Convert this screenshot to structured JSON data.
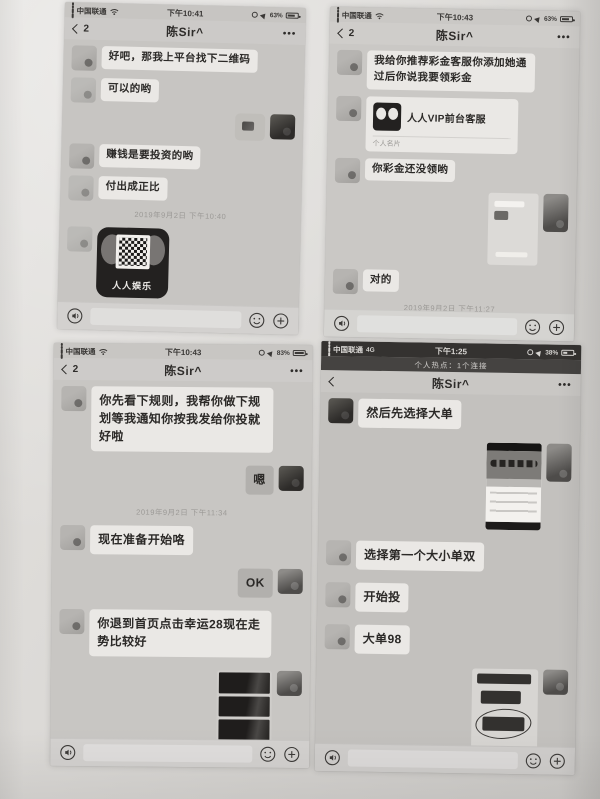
{
  "icons": {
    "more": "•••"
  },
  "phones": [
    {
      "status": {
        "carrier": "中国联通",
        "time": "下午10:41",
        "battery": "63%"
      },
      "nav": {
        "unread": "2",
        "title": "陈Sir^"
      },
      "messages": {
        "m1": "好吧，那我上平台找下二维码",
        "m2": "可以的哟",
        "m3": "赚钱是要投资的哟",
        "m4": "付出成正比",
        "timestamp": "2019年9月2日 下午10:40",
        "qr_label": "人人娱乐",
        "m5": "你扫码进入按里面点击右上角三个点，在浏览器打开下载"
      }
    },
    {
      "status": {
        "carrier": "中国联通",
        "time": "下午10:43",
        "battery": "63%"
      },
      "nav": {
        "unread": "2",
        "title": "陈Sir^"
      },
      "messages": {
        "m1": "我给你推荐彩金客服你添加她通过后你说我要领彩金",
        "card_title": "人人VIP前台客服",
        "card_subtitle": "个人名片",
        "m2": "你彩金还没领哟",
        "m3": "对的",
        "timestamp": "2019年9月2日 下午11:27"
      }
    },
    {
      "status": {
        "carrier": "中国联通",
        "time": "下午10:43",
        "battery": "83%"
      },
      "nav": {
        "unread": "2",
        "title": "陈Sir^"
      },
      "messages": {
        "m1": "你先看下规则，我帮你做下规划等我通知你按我发给你投就好啦",
        "m2": "嗯",
        "timestamp": "2019年9月2日 下午11:34",
        "m3": "现在准备开始咯",
        "m4": "OK",
        "m5": "你退到首页点击幸运28现在走势比较好"
      }
    },
    {
      "status": {
        "carrier": "中国联通",
        "network": "4G",
        "time": "下午1:25",
        "battery": "38%"
      },
      "hotspot": "个人热点：1个连接",
      "nav": {
        "title": "陈Sir^"
      },
      "messages": {
        "m1": "然后先选择大单",
        "m2": "选择第一个大小单双",
        "m3": "开始投",
        "m4": "大单98"
      }
    }
  ]
}
